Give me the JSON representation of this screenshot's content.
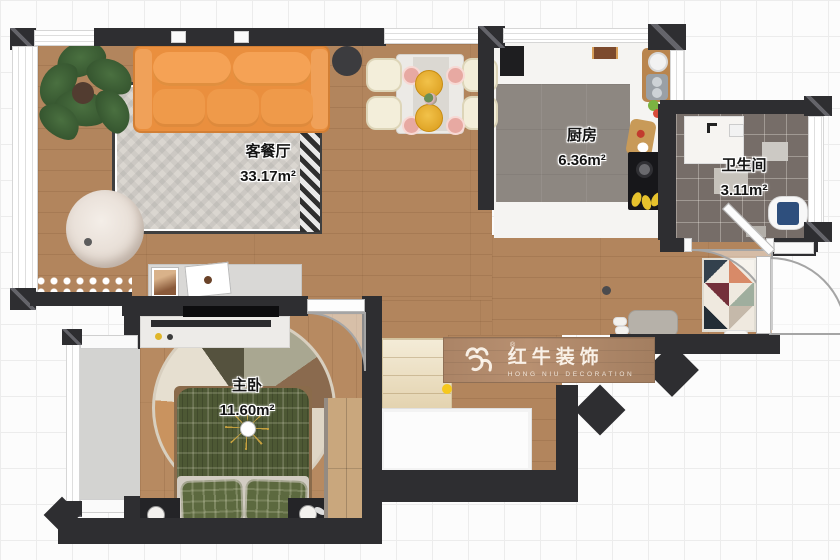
{
  "plan": {
    "rooms": [
      {
        "name": "客餐厅",
        "area": "33.17m²"
      },
      {
        "name": "厨房",
        "area": "6.36m²"
      },
      {
        "name": "卫生间",
        "area": "3.11m²"
      },
      {
        "name": "主卧",
        "area": "11.60m²"
      }
    ],
    "watermark": {
      "brand": "红牛装饰",
      "subtitle": "HONG NIU DECORATION",
      "registered_mark": "®"
    },
    "colors": {
      "wall": "#2e2e31",
      "wood_floor": "#b2855d",
      "kitchen_floor": "#8d8781",
      "bathroom_floor": "#766d68",
      "sofa_orange": "#ef9440",
      "bed_green": "#4d5834",
      "accent_yellow": "#f6c81e",
      "watermark_wood": "#ab8466"
    }
  }
}
